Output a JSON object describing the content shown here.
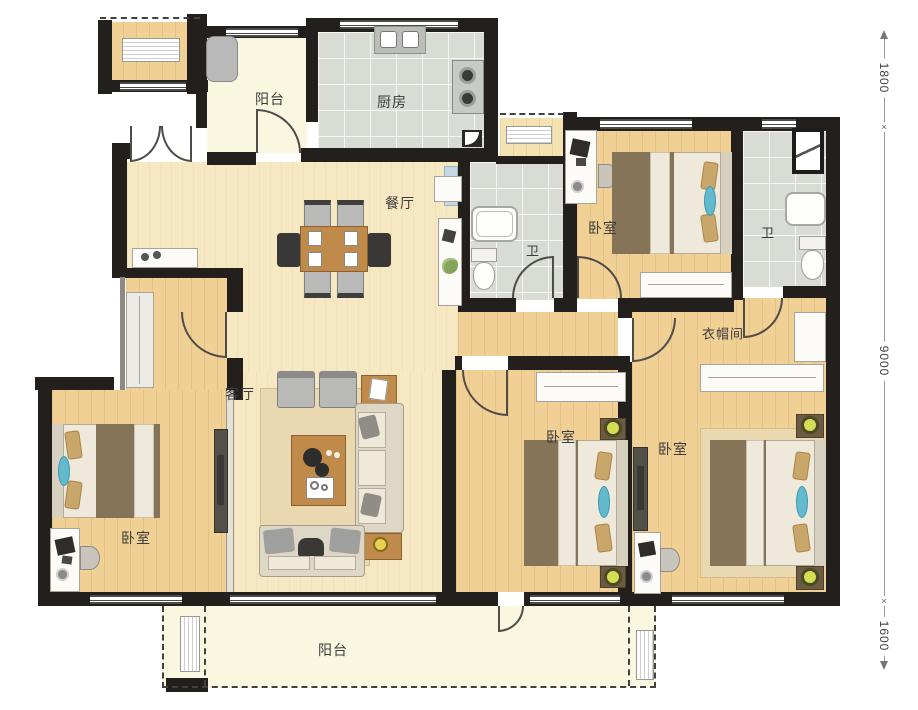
{
  "rooms": {
    "balcony_top": {
      "label": "阳台"
    },
    "kitchen": {
      "label": "厨房"
    },
    "dining": {
      "label": "餐厅"
    },
    "bath_middle": {
      "label": "卫"
    },
    "bedroom_top_right": {
      "label": "卧室"
    },
    "bath_right": {
      "label": "卫"
    },
    "closet": {
      "label": "衣帽间"
    },
    "living": {
      "label": "客厅"
    },
    "bedroom_left": {
      "label": "卧室"
    },
    "bedroom_bottom_middle": {
      "label": "卧室"
    },
    "bedroom_bottom_right": {
      "label": "卧室"
    },
    "balcony_bottom": {
      "label": "阳台"
    }
  },
  "dimensions": {
    "tick": "×",
    "segments": [
      {
        "value": "1800"
      },
      {
        "value": "9000"
      },
      {
        "value": "1600"
      }
    ]
  },
  "colors": {
    "wall": "#221f1c",
    "wood_floor": "#f0d095",
    "living_floor": "#f6e8c2",
    "tile_floor": "#d9dcd5",
    "balcony_floor": "#faf7e1",
    "accent_teal": "#63b9cd",
    "accent_lamp": "#d3de55"
  }
}
